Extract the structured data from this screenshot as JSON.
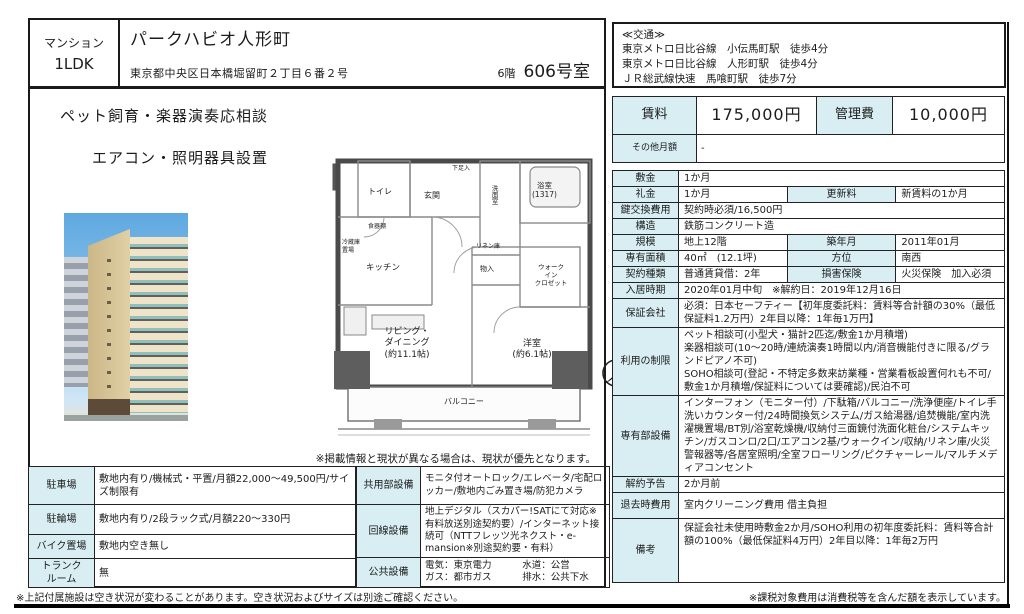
{
  "colors": {
    "label_bg": "#d9eef3",
    "border": "#1a1a1a"
  },
  "header": {
    "category": "マンション",
    "layout": "1LDK",
    "title": "パークハビオ人形町",
    "address": "東京都中央区日本橋堀留町２丁目６番２号",
    "floor": "6階",
    "room": "606号室"
  },
  "access": {
    "heading": "≪交通≫",
    "lines": [
      "東京メトロ日比谷線　小伝馬町駅　徒歩4分",
      "東京メトロ日比谷線　人形町駅　徒歩4分",
      "ＪＲ総武線快速　馬喰町駅　徒歩7分"
    ]
  },
  "features": [
    "ペット飼育・楽器演奏応相談",
    "エアコン・照明器具設置"
  ],
  "rent": {
    "rent_label": "賃料",
    "rent_value": "175,000円",
    "fee_label": "管理費",
    "fee_value": "10,000円",
    "other_label": "その他月額",
    "other_value": "-"
  },
  "details": {
    "shikikin": {
      "label": "敷金",
      "value": "1か月"
    },
    "reikin": {
      "label": "礼金",
      "value": "1か月"
    },
    "koushin": {
      "label": "更新料",
      "value": "新賃料の1か月"
    },
    "kagi": {
      "label": "鍵交換費用",
      "value": "契約時必須/16,500円"
    },
    "kouzou": {
      "label": "構造",
      "value": "鉄筋コンクリート造"
    },
    "kibo": {
      "label": "規模",
      "value": "地上12階"
    },
    "chikunen": {
      "label": "築年月",
      "value": "2011年01月"
    },
    "menseki": {
      "label": "専有面積",
      "value": "40㎡　(12.1坪)"
    },
    "houi": {
      "label": "方位",
      "value": "南西"
    },
    "keiyaku": {
      "label": "契約種類",
      "value": "普通賃貸借：2年"
    },
    "hoken": {
      "label": "損害保険",
      "value": "火災保険　加入必須"
    },
    "nyukyo": {
      "label": "入居時期",
      "value": "2020年01月中旬　※解約日：2019年12月16日"
    },
    "hoshou": {
      "label": "保証会社",
      "value": "必須：日本セーフティー【初年度委託料：賃料等合計額の30%（最低保証料1.2万円）2年目以降：1年毎1万円】"
    },
    "seigen": {
      "label": "利用の制限",
      "value": "ペット相談可(小型犬・猫計2匹迄/敷金1か月積増)\n楽器相談可(10～20時/連続演奏1時間以内/消音機能付きに限る/グランドピアノ不可)\nSOHO相談可(登記・不特定多数来訪業種・営業看板設置何れも不可/敷金1か月積増/保証料については要確認)/民泊不可"
    },
    "setsubi": {
      "label": "専有部設備",
      "value": "インターフォン（モニター付）/下駄箱/バルコニー/洗浄便座/トイレ手洗いカウンター付/24時間換気システム/ガス給湯器/追焚機能/室内洗濯機置場/BT別/浴室乾燥機/収納付三面鏡付洗面化粧台/システムキッチン/ガスコンロ/2口/エアコン2基/ウォークイン/収納/リネン庫/火災警報器等/各居室照明/全室フローリング/ピクチャーレール/マルチメディアコンセント"
    },
    "kaiyaku": {
      "label": "解約予告",
      "value": "2か月前"
    },
    "taikyo": {
      "label": "退去時費用",
      "value": "室内クリーニング費用 借主負担"
    },
    "biko": {
      "label": "備考",
      "value": "保証会社未使用時敷金2か月/SOHO利用の初年度委託料：賃料等合計額の100%（最低保証料4万円）2年目以降：1年毎2万円"
    }
  },
  "facilities": {
    "parking": {
      "label": "駐車場",
      "value": "敷地内有り/機械式・平置/月額22,000～49,500円/サイズ制限有"
    },
    "bicycle": {
      "label": "駐輪場",
      "value": "敷地内有り/2段ラック式/月額220～330円"
    },
    "bike": {
      "label": "バイク置場",
      "value": "敷地内空き無し"
    },
    "trunk": {
      "label": "トランク\nルーム",
      "value": "無"
    }
  },
  "common": {
    "kyouyou": {
      "label": "共用部設備",
      "value": "モニタ付オートロック/エレベータ/宅配ロッカー/敷地内ごみ置き場/防犯カメラ"
    },
    "kaisen": {
      "label": "回線設備",
      "value": "地上デジタル（スカパー!SATにて対応※有料放送別途契約要）/インターネット接続可（NTTフレッツ光ネクスト・e-mansion※別途契約要・有料）"
    },
    "koukyou": {
      "label": "公共設備",
      "left": "電気：東京電力\nガス：都市ガス",
      "right": "水道：公営\n排水：公共下水"
    }
  },
  "floorplan": {
    "labels": {
      "toilet": "トイレ",
      "genkan": "玄関",
      "shoe": "下足入",
      "wash": "洗面室",
      "bath": "浴室\n(1317)",
      "kitchen": "キッチン",
      "dish": "食器棚",
      "fridge": "冷蔵庫\n置場",
      "linen": "リネン庫",
      "mono": "物入",
      "wic": "ウォーク\nイン\nクロゼット",
      "living": "リビング・\nダイニング\n(約11.1帖)",
      "bedroom": "洋室\n(約6.1帖)",
      "balcony": "バルコニー"
    }
  },
  "notes": {
    "floorplan": "※掲載情報と現状が異なる場合は、現状が優先となります。",
    "bottom_left": "※上記付属施設は空き状況が変わることがあります。空き状況およびサイズは別途ご確認ください。",
    "bottom_right": "※課税対象費用は消費税等を含んだ額を表示しています。"
  }
}
